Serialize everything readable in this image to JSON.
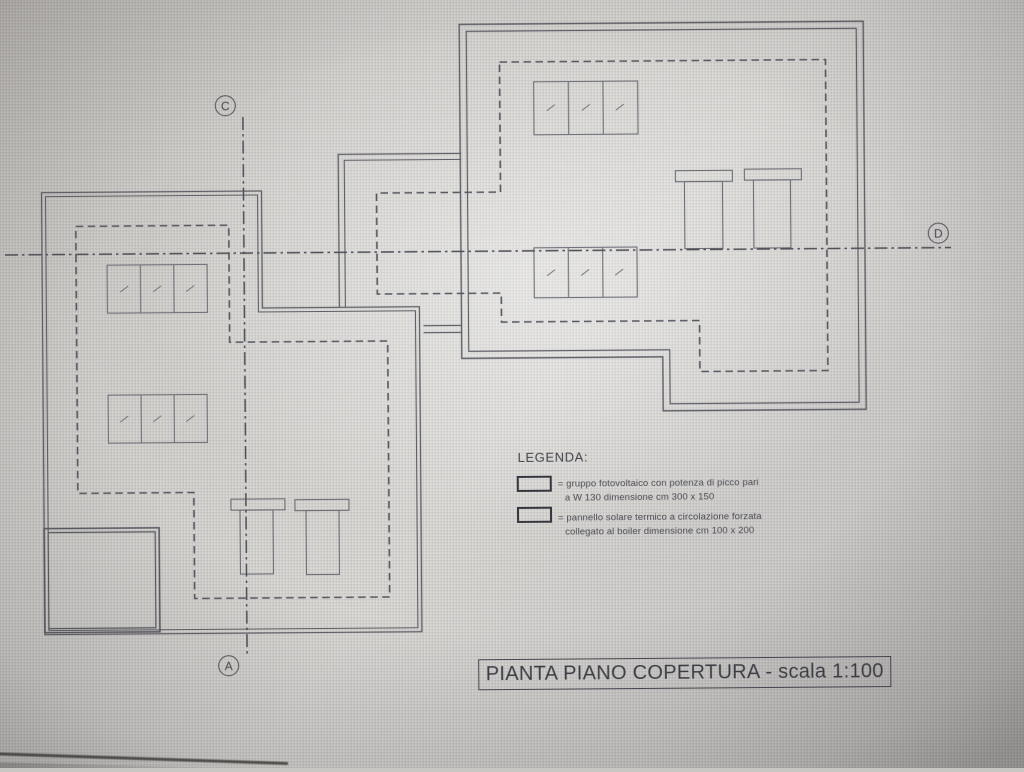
{
  "drawing": {
    "title": "PIANTA PIANO COPERTURA - scala 1:100",
    "section_markers": {
      "top": "C",
      "bottom": "A",
      "right": "D"
    },
    "legend": {
      "heading": "LEGENDA:",
      "items": [
        {
          "symbol": "photovoltaic-group-box",
          "line1": "= gruppo fotovoltaico con potenza di picco pari",
          "line2": "a W 130 dimensione cm 300 x 150"
        },
        {
          "symbol": "solar-thermal-panel-box",
          "line1": "= pannello solare termico a circolazione forzata",
          "line2": "collegato al boiler dimensione cm 100 x 200"
        }
      ]
    },
    "colors": {
      "line": "#5e5e66",
      "dashed_line": "#565660",
      "paper": "#d6d5d2",
      "text": "#45454c"
    }
  }
}
